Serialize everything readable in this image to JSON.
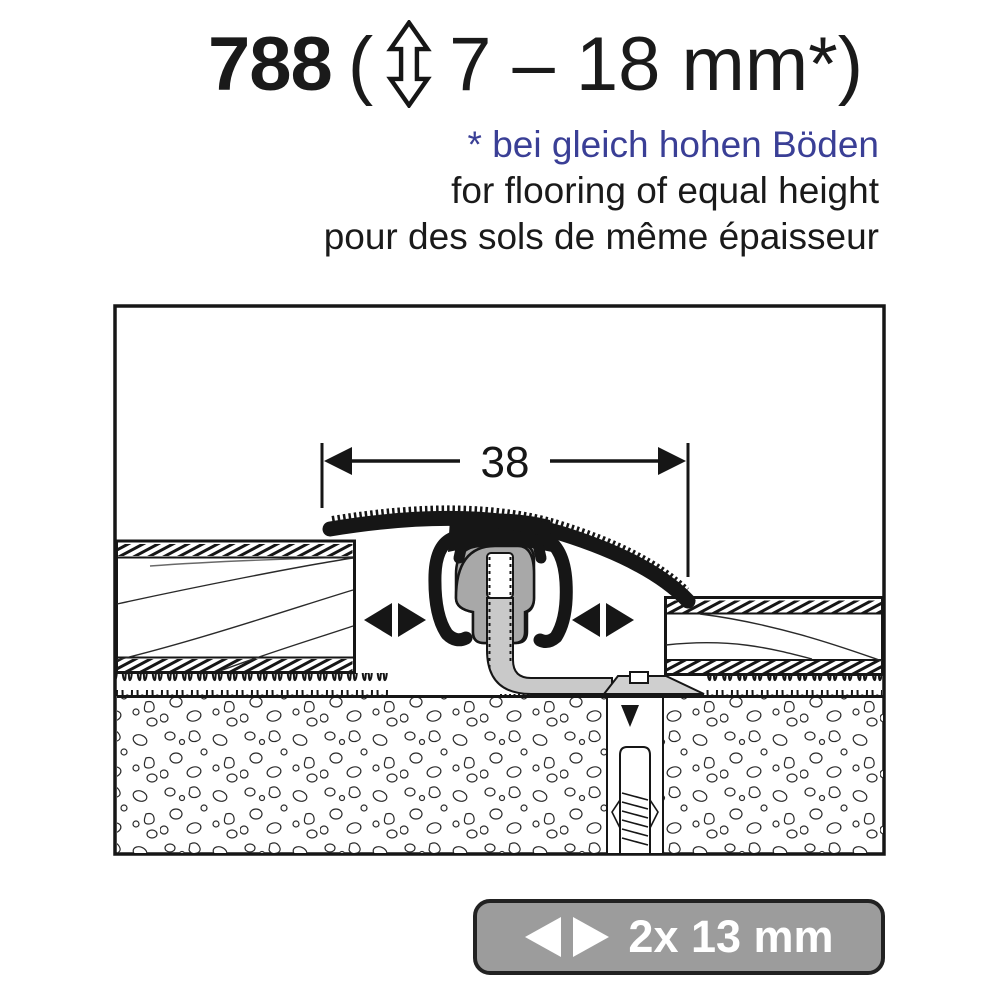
{
  "title": {
    "product_number": "788",
    "open_paren": "(",
    "range": "7 – 18 mm*)"
  },
  "notes": {
    "de": "* bei gleich hohen Böden",
    "en": "for flooring of equal height",
    "fr": "pour des sols de même épaisseur"
  },
  "diagram": {
    "width_label": "38"
  },
  "badge": {
    "label": "2x 13 mm"
  },
  "icons": {
    "title_icon": "double-vertical-arrow-icon",
    "badge_icon": "left-right-arrows-icon",
    "diagram_icons": [
      "expansion-arrows-icon",
      "down-arrow-icon"
    ]
  },
  "colors": {
    "accent_blue": "#3a3f96",
    "badge_gray": "#9c9c9c",
    "clip_gray": "#a8a8a8",
    "rod_gray": "#c9c9c9",
    "anchor_gray": "#cfcfcf",
    "line_black": "#161616"
  }
}
